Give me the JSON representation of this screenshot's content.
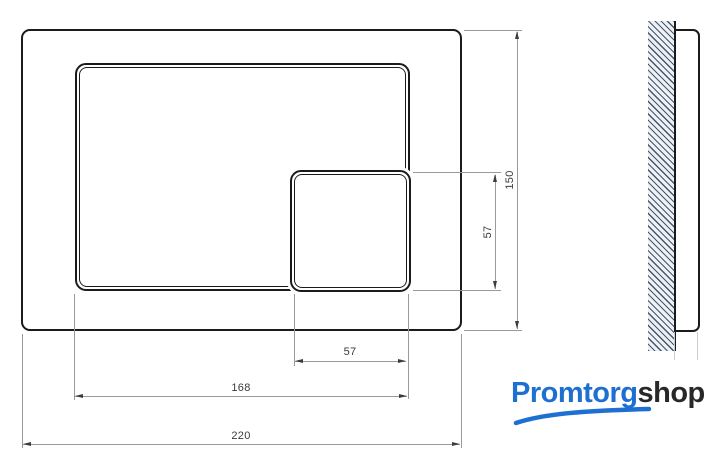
{
  "drawing": {
    "front_view": {
      "overall_width_mm": "220",
      "overall_height_mm": "150",
      "large_button_width_mm": "168",
      "small_button_width_mm": "57",
      "small_button_height_mm": "57"
    }
  },
  "logo": {
    "primary": "Promtorg",
    "secondary": "shop"
  },
  "colors": {
    "outline": "#1b1b1b",
    "dimension_line": "#9a9a9a",
    "dimension_text": "#3a3a3a",
    "hatch_line": "#46566b",
    "hatch_bg": "#edf1f5",
    "logo_blue": "#1e6fd2",
    "logo_dark": "#282828"
  }
}
